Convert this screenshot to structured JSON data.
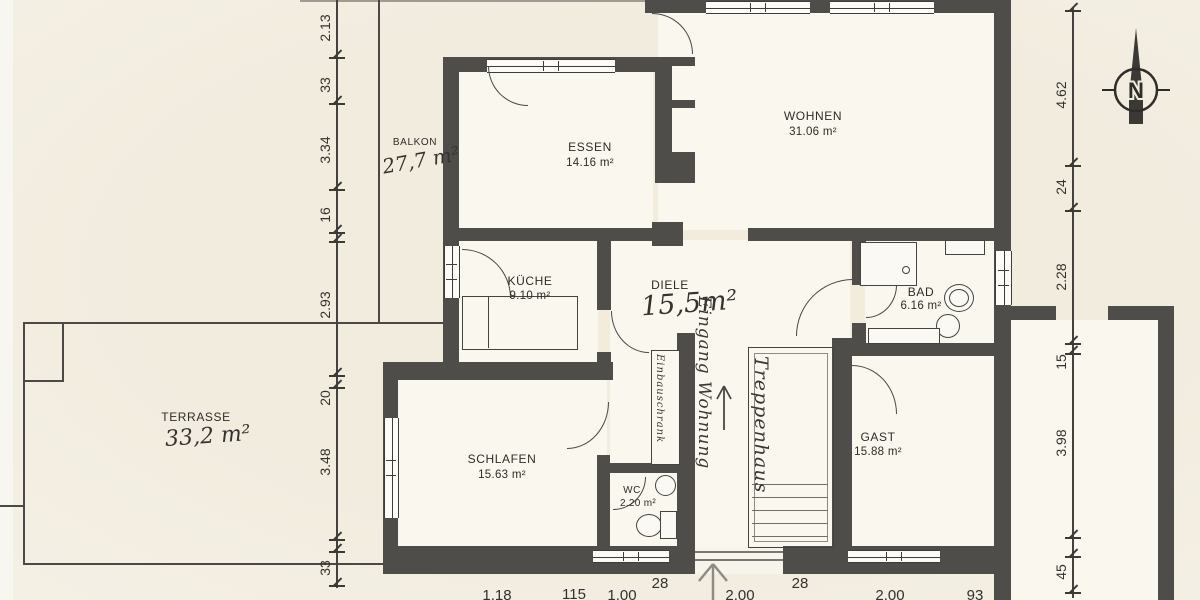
{
  "rooms": {
    "balkon": {
      "name": "BALKON",
      "area": "27,7 m²"
    },
    "essen": {
      "name": "ESSEN",
      "area": "14.16 m²"
    },
    "wohnen": {
      "name": "WOHNEN",
      "area": "31.06 m²"
    },
    "kueche": {
      "name": "KÜCHE",
      "area": "9.10 m²"
    },
    "diele": {
      "name": "DIELE",
      "area": "15,5m²"
    },
    "bad": {
      "name": "BAD",
      "area": "6.16 m²"
    },
    "terrasse": {
      "name": "TERRASSE",
      "area": "33,2 m²"
    },
    "schlafen": {
      "name": "SCHLAFEN",
      "area": "15.63 m²"
    },
    "gast": {
      "name": "GAST",
      "area": "15.88 m²"
    },
    "wc": {
      "name": "WC",
      "area": "2.20 m²"
    }
  },
  "annotations": {
    "entry": "Eingang Wohnung",
    "closet": "Einbauschrank",
    "stairs": "Treppenhaus"
  },
  "compass": {
    "label": "N"
  },
  "dimensions": {
    "left": [
      "2.13",
      "33",
      "3.34",
      "16",
      "2.93",
      "20",
      "3.48",
      "33"
    ],
    "right": [
      "4.62",
      "24",
      "2.28",
      "15",
      "3.98",
      "45"
    ],
    "bottom": [
      "1.18",
      "115",
      "1.00",
      "28",
      "2.00",
      "28",
      "2.00",
      "93"
    ]
  },
  "colors": {
    "wall": "#4f4d49",
    "paper": "#f2ecdf",
    "ink": "#3a3834"
  }
}
